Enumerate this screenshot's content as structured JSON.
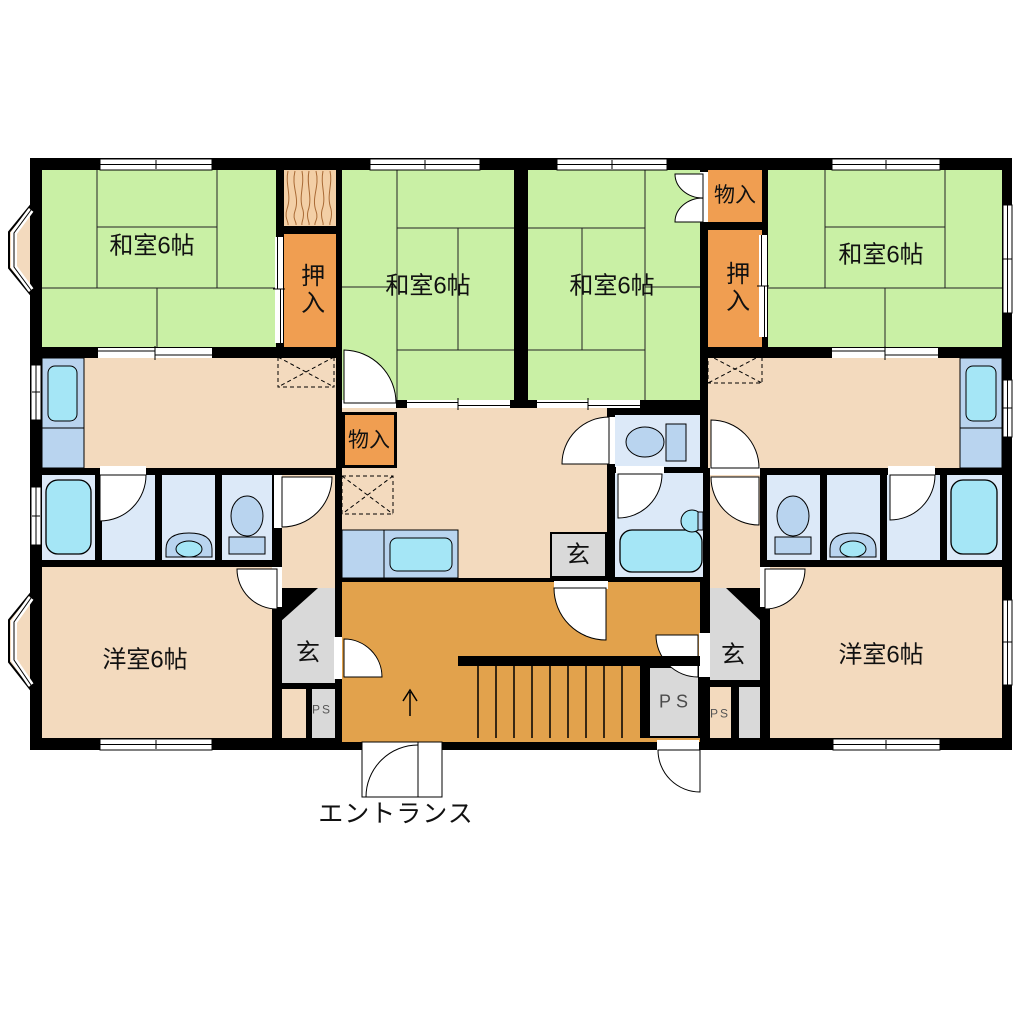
{
  "title": "apartment-floor-plan",
  "labels": {
    "washitsu": "和室6帖",
    "yoshitsu": "洋室6帖",
    "oshiire": "押入",
    "monoire": "物入",
    "genkan": "玄",
    "ps": "PS",
    "ps_small": "PS",
    "entrance": "エントランス"
  },
  "rooms": {
    "japanese_rooms_count": 4,
    "western_rooms_count": 2,
    "japanese_room_size": "6帖",
    "western_room_size": "6帖"
  },
  "colors": {
    "wall": "#000000",
    "tatami": "#c9f0a5",
    "floor_beige": "#f3dabe",
    "closet_orange": "#f09e51",
    "hall_orange": "#e2a24c",
    "genkan_gray": "#d9d9d9",
    "bath_blue": "#dce9f8",
    "fixture_blue": "#b9d4ef",
    "water_cyan": "#a5e6f6",
    "wood": "#f3cfa6",
    "wood_line": "#a96a35"
  }
}
